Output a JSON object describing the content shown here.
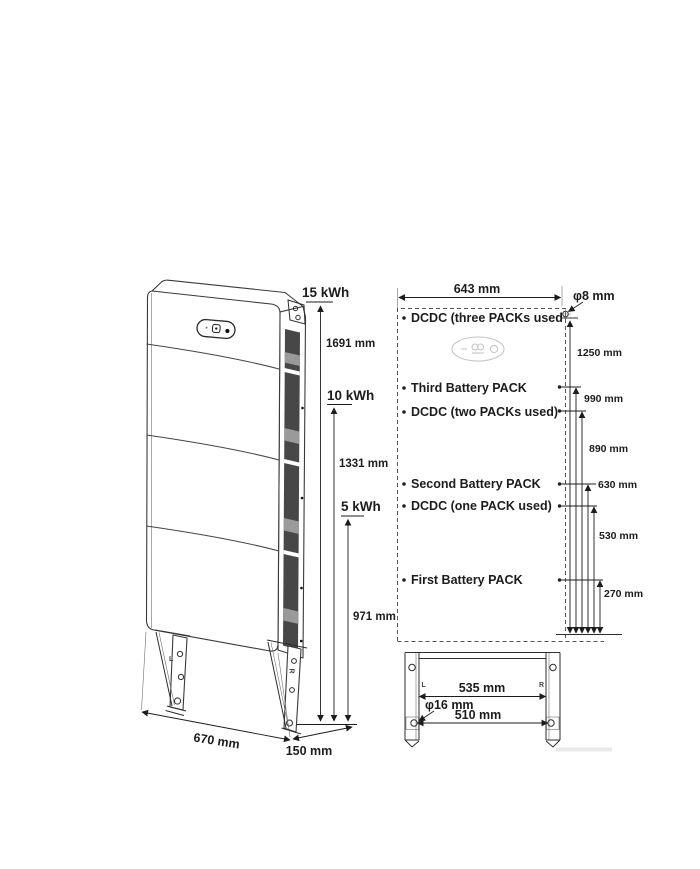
{
  "diagram": {
    "perspective_view": {
      "capacity_labels": [
        "15 kWh",
        "10 kWh",
        "5 kWh"
      ],
      "height_labels": [
        "1691 mm",
        "1331 mm",
        "971 mm"
      ],
      "width_label": "670 mm",
      "depth_label": "150 mm",
      "bracket_marks": {
        "left": "L",
        "right": "R"
      }
    },
    "front_view": {
      "top_width_label": "643 mm",
      "wall_hole_label": "φ8 mm",
      "component_labels": [
        "DCDC (three PACKs used",
        "Third Battery PACK",
        "DCDC (two PACKs used)",
        "Second Battery PACK",
        "DCDC (one PACK used)",
        "First Battery PACK"
      ],
      "height_labels": [
        "1250 mm",
        "990 mm",
        "890 mm",
        "630 mm",
        "530 mm",
        "270 mm"
      ],
      "stand": {
        "hole_label": "φ16 mm",
        "upper_width_label": "535 mm",
        "lower_width_label": "510 mm",
        "bracket_marks": {
          "left": "L",
          "right": "R"
        }
      }
    },
    "colors": {
      "line": "#2e2e2e",
      "vent_dark": "#474747",
      "badge_gray": "#c6c6c6"
    }
  }
}
